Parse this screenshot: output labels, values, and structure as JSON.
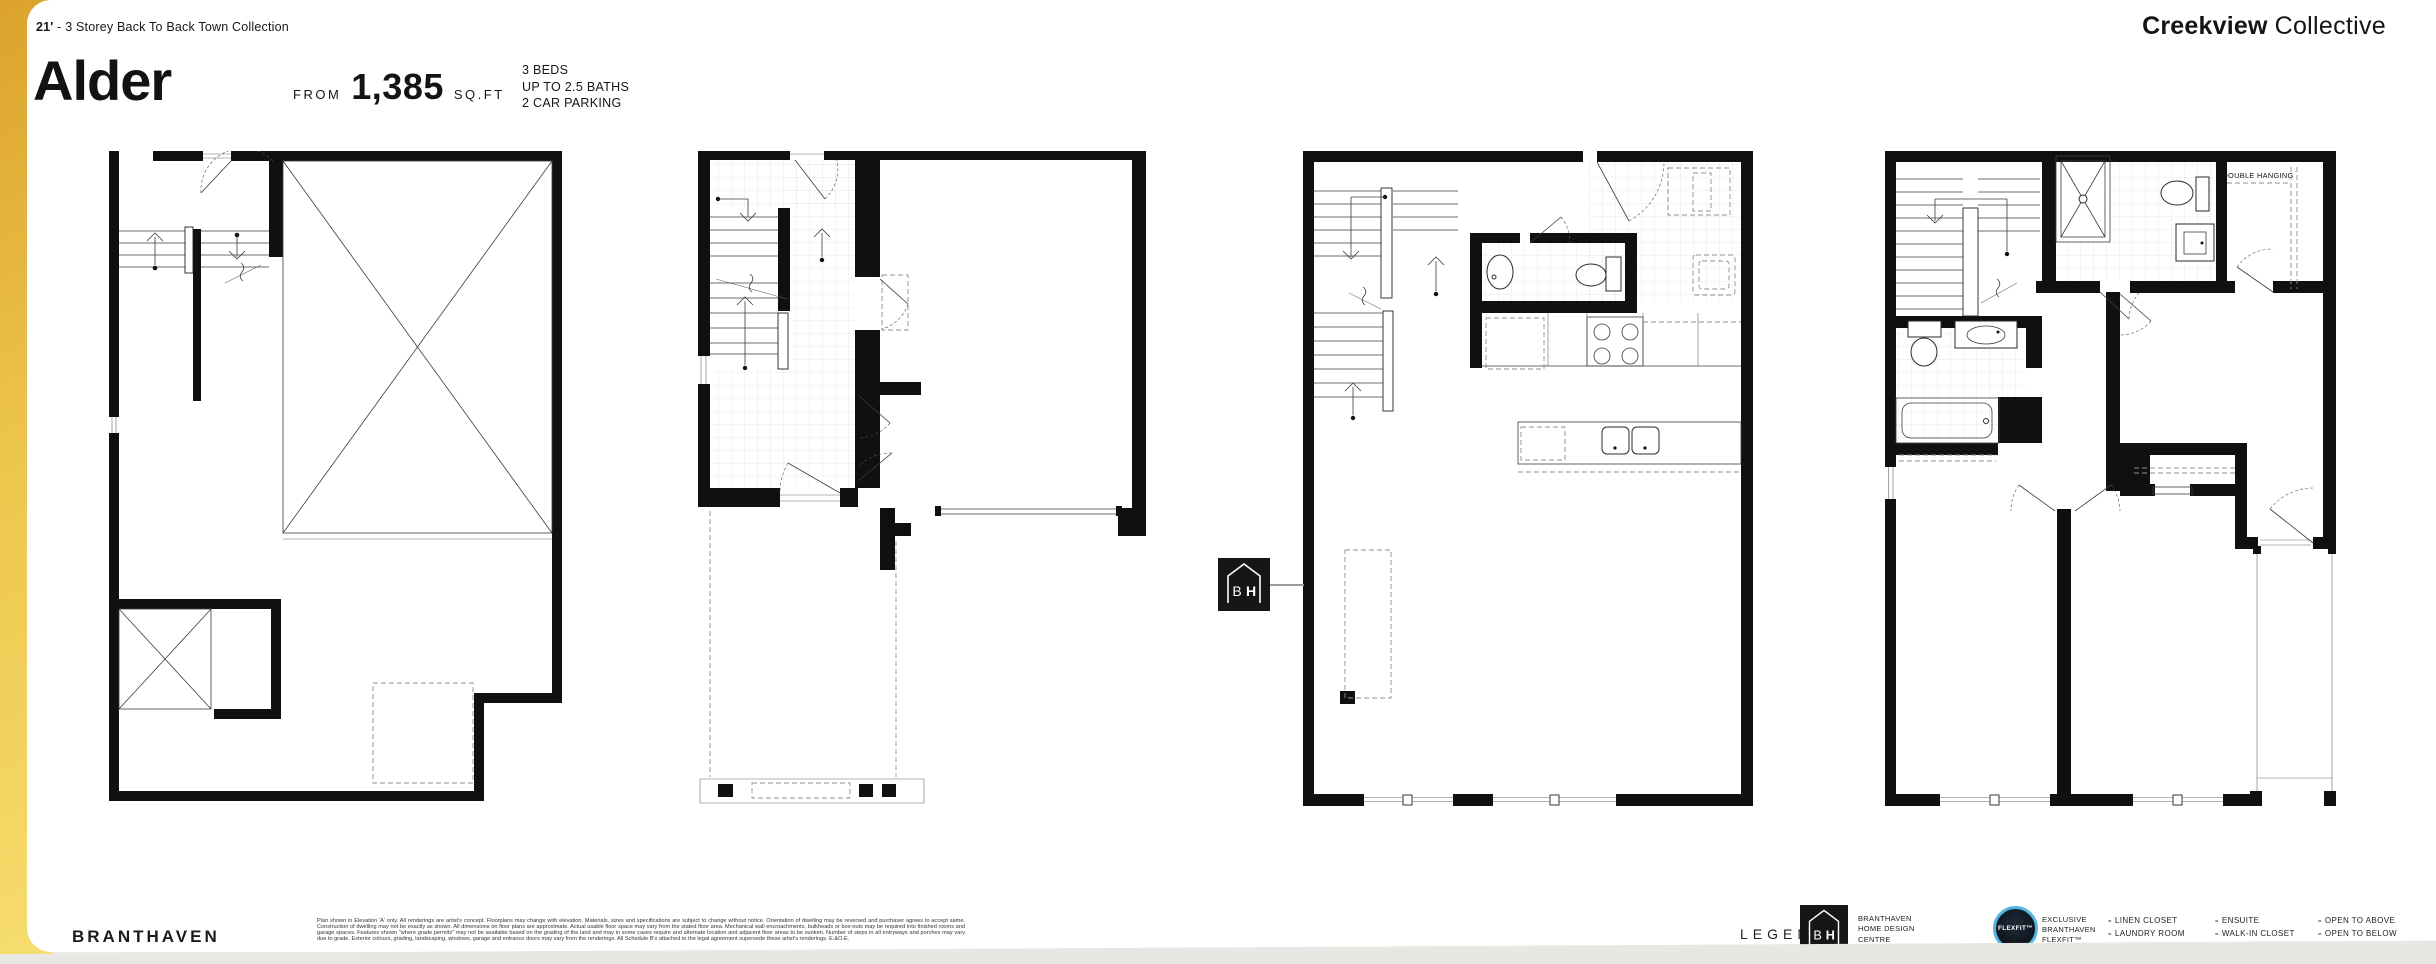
{
  "header": {
    "collection_prefix": "21'",
    "collection_rest": " - 3 Storey Back To Back Town Collection",
    "model_name": "Alder",
    "from_label": "FROM",
    "area_value": "1,385",
    "area_unit": "SQ.FT",
    "specs": [
      "3 BEDS",
      "UP TO 2.5 BATHS",
      "2 CAR PARKING"
    ],
    "brand_bold": "Creekview",
    "brand_light": "Collective"
  },
  "plans": [
    {
      "name": "lower level"
    },
    {
      "name": "ground floor"
    },
    {
      "name": "main floor"
    },
    {
      "name": "third floor",
      "closet_label": "DOUBLE HANGING"
    }
  ],
  "bh_badge": {
    "b": "B",
    "h": "H"
  },
  "footer": {
    "builder": "BRANTHAVEN",
    "disclaimer": "Plan shown in Elevation 'A' only. All renderings are artist's concept. Floorplans may change with elevation. Materials, sizes and specifications are subject to change without notice. Orientation of dwelling may be reversed and purchaser agrees to accept same. Construction of dwelling may not be exactly as shown. All dimensions on floor plans are approximate. Actual usable floor space may vary from the stated floor area. Mechanical wall encroachments, bulkheads or box-outs may be required into finished rooms and garage spaces. Features shown \"where grade permits\" may not be available based on the grading of the land and may in some cases require and alternate location and adjacent floor areas to be sunken. Number of steps in all entryways and porches may vary due to grade. Exterior colours, grading, landscaping, windows, garage and entrance doors may vary from the renderings. All Schedule B's attached to the legal agreement supersede these artist's renderings. E.&O.E."
  },
  "legend": {
    "title": "LEGEND",
    "bh_lines": [
      "BRANTHAVEN",
      "HOME DESIGN",
      "CENTRE"
    ],
    "flexfit_badge_text": "FLEXFIT™",
    "flexfit_lines": [
      "EXCLUSIVE",
      "BRANTHAVEN",
      "FLEXFIT™"
    ],
    "item_prefix": "=",
    "columns": [
      [
        "LINEN CLOSET",
        "LAUNDRY ROOM",
        "POWDER ROOM"
      ],
      [
        "ENSUITE",
        "WALK-IN CLOSET",
        "OPTIONAL"
      ],
      [
        "OPEN TO ABOVE",
        "OPEN TO BELOW"
      ]
    ]
  }
}
